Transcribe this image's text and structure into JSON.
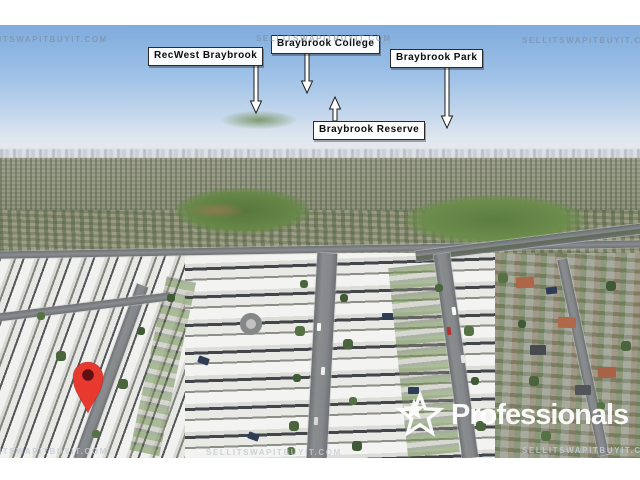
{
  "watermarks": [
    {
      "id": "top-left",
      "text": "LLITSWAPITBUYIT.COM"
    },
    {
      "id": "top-center",
      "text": "SELLITSWAPITBUYIT.COM"
    },
    {
      "id": "top-right",
      "text": "SELLITSWAPITBUYIT.C"
    },
    {
      "id": "bottom-left",
      "text": "LLITSWAPITBUYIT.COM"
    },
    {
      "id": "bottom-center",
      "text": "SELLITSWAPITBUYIT.COM"
    },
    {
      "id": "bottom-right",
      "text": "SELLITSWAPITBUYIT.C"
    }
  ],
  "callouts": [
    {
      "name": "recwest-braybrook",
      "text": "RecWest Braybrook",
      "arrow_direction": "down"
    },
    {
      "name": "braybrook-college",
      "text": "Braybrook College",
      "arrow_direction": "down"
    },
    {
      "name": "braybrook-park",
      "text": "Braybrook Park",
      "arrow_direction": "down"
    },
    {
      "name": "braybrook-reserve",
      "text": "Braybrook Reserve",
      "arrow_direction": "up"
    }
  ],
  "marker": {
    "icon": "location-pin-icon",
    "color": "#e8392f",
    "inner_color": "#5f1012"
  },
  "logo": {
    "icon": "star-icon",
    "text": "Professionals",
    "color": "#ffffff"
  },
  "colors": {
    "label_bg": "#fdfdfd",
    "label_border": "#2b2b2b",
    "arrow_fill": "#ffffff",
    "arrow_stroke": "#1f1f1f",
    "watermark": "#7d8a9e",
    "sky_top": "#7fabdc",
    "sky_horizon": "#e9eef3",
    "frame_bars": "#ffffff"
  }
}
